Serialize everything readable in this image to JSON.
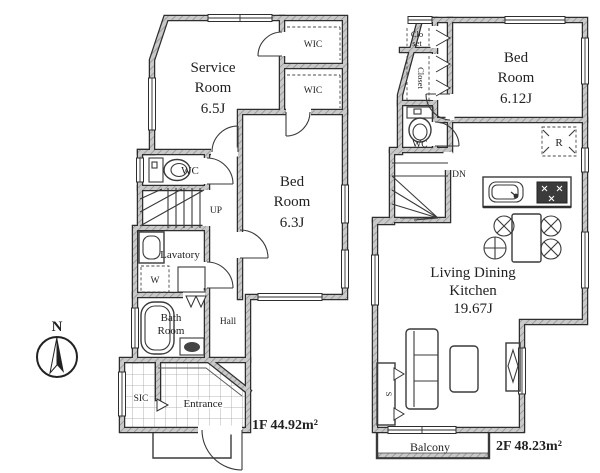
{
  "colors": {
    "wall_outline": "#2e2e2e",
    "wall_hatch_fill": "#bdbdbd",
    "line": "#3a3a3a",
    "text": "#222222",
    "background": "#ffffff"
  },
  "compass": {
    "north_label": "N"
  },
  "floor1": {
    "area_label": "1F 44.92m²",
    "service_room": {
      "line1": "Service",
      "line2": "Room",
      "line3": "6.5J"
    },
    "wic_upper": "WIC",
    "wic_lower": "WIC",
    "wc": "WC",
    "stairs": "UP",
    "lavatory": "Lavatory",
    "washer": "W",
    "bed_room": {
      "line1": "Bed",
      "line2": "Room",
      "line3": "6.3J"
    },
    "bath_room": {
      "line1": "Bath",
      "line2": "Room"
    },
    "hall": "Hall",
    "sic": "SIC",
    "entrance": "Entrance"
  },
  "floor2": {
    "area_label": "2F 48.23m²",
    "closet_upper": {
      "line1": "Clo",
      "line2": "set"
    },
    "closet_side": "Closet",
    "wc": "WC",
    "stairs": "DN",
    "bed_room": {
      "line1": "Bed",
      "line2": "Room",
      "line3": "6.12J"
    },
    "refrigerator": "R",
    "ldk": {
      "line1": "Living Dining",
      "line2": "Kitchen",
      "line3": "19.67J"
    },
    "storage": "S",
    "balcony": "Balcony"
  }
}
